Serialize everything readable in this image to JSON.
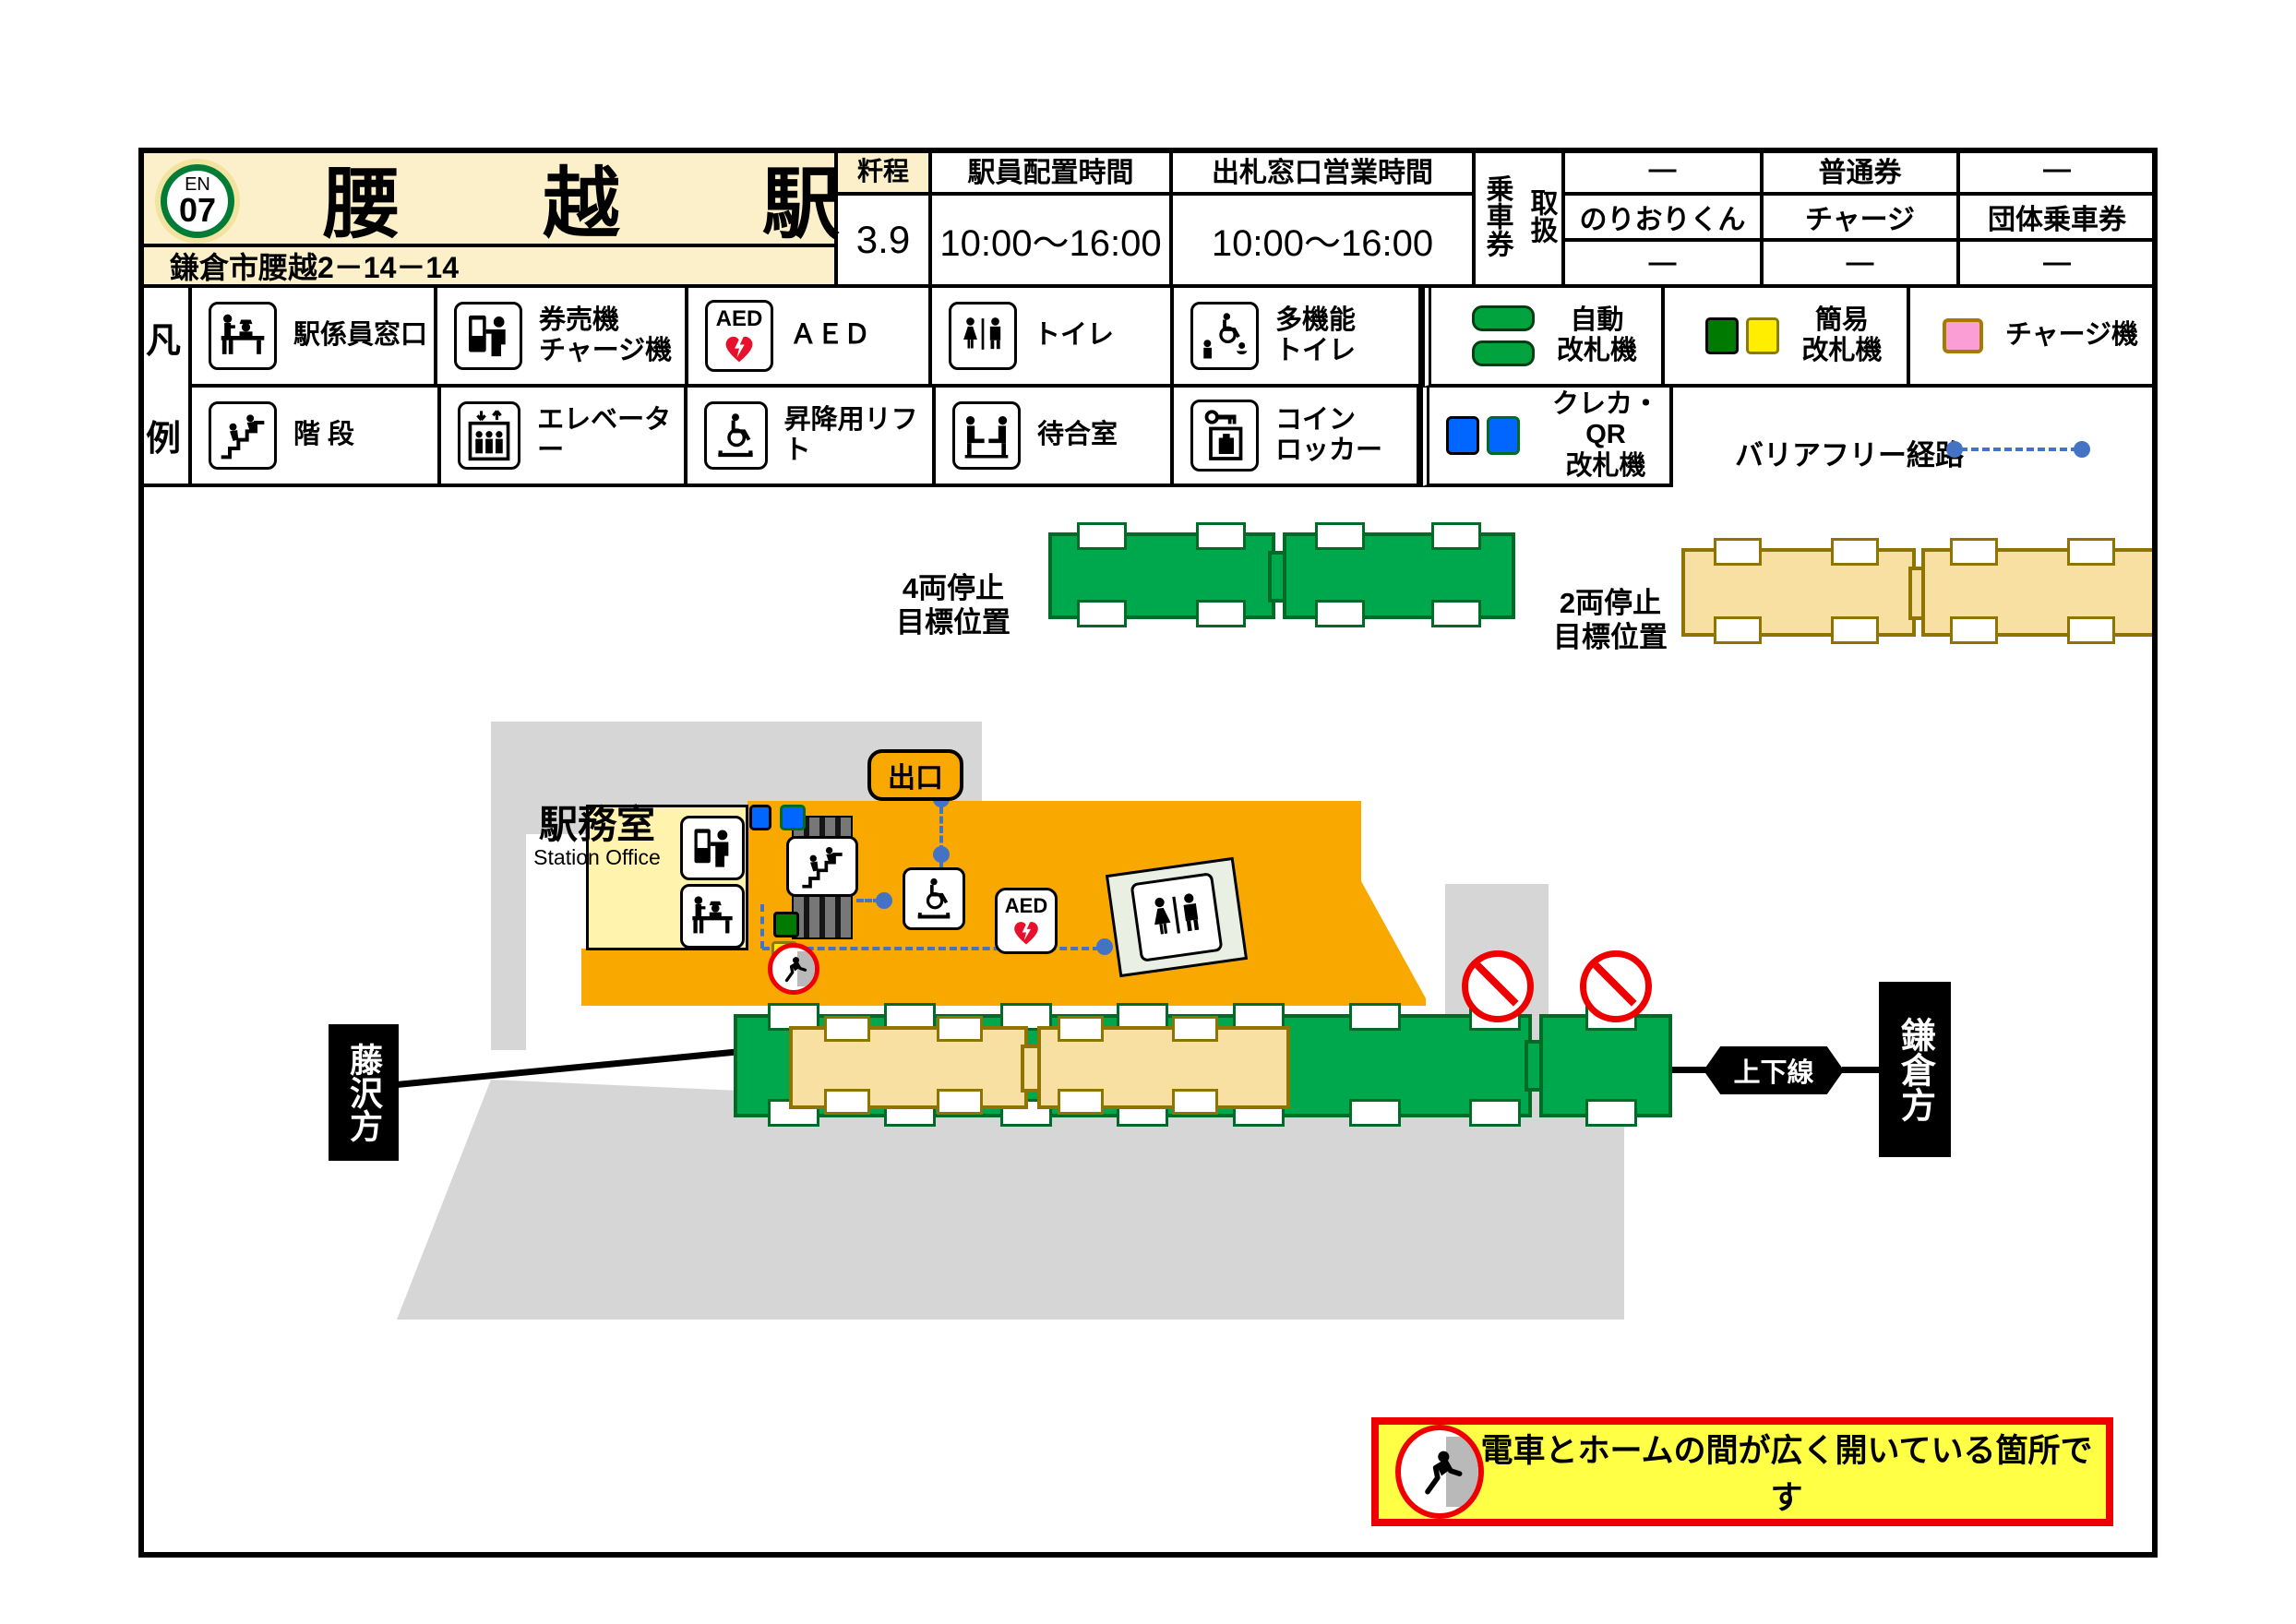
{
  "header": {
    "badge_line": "EN",
    "badge_number": "07",
    "station_name_chars": [
      "腰",
      "越",
      "駅"
    ],
    "address": "鎌倉市腰越2－14－14",
    "mileage_label": "粁程",
    "mileage_value": "3.9",
    "staff_hours_label": "駅員配置時間",
    "staff_hours_value": "10:00〜16:00",
    "ticket_window_label": "出札窓口営業時間",
    "ticket_window_value": "10:00〜16:00",
    "ticket_handling_col_left": "乗車券",
    "ticket_handling_col_right": "取扱",
    "ticket_table": [
      [
        "—",
        "普通券",
        "—"
      ],
      [
        "のりおりくん",
        "チャージ",
        "団体乗車券"
      ],
      [
        "—",
        "—",
        "—"
      ]
    ]
  },
  "legend": {
    "title_chars": [
      "凡",
      "例"
    ],
    "row1_labels": [
      "駅係員窓口",
      "券売機\nチャージ機",
      "ＡＥＤ",
      "トイレ",
      "多機能\nトイレ",
      "自動\n改札機",
      "簡易\n改札機",
      "チャージ機"
    ],
    "row2_labels": [
      "階 段",
      "エレベーター",
      "昇降用リフト",
      "待合室",
      "コイン\nロッカー",
      "クレカ・QR\n改札機"
    ],
    "barrier_free_label": "バリアフリー経路",
    "aed_text": "AED"
  },
  "stop_positions": {
    "four_car_label": "4両停止\n目標位置",
    "two_car_label": "2両停止\n目標位置"
  },
  "map": {
    "office_title": "駅務室",
    "office_subtitle": "Station Office",
    "exit_label": "出口",
    "updown_line_label": "上下線",
    "kamakura_label": "鎌倉方",
    "fujisawa_label": "藤沢方",
    "aed_text": "AED"
  },
  "warning_banner": {
    "text": "電車とホームの間が広く開いている箇所です"
  },
  "colors": {
    "line_green": "#007C36",
    "header_cream": "#FBF0C9",
    "concourse_orange": "#F9A800",
    "office_yellow": "#FFF3AE",
    "train_green": "#00A84D",
    "train_green_border": "#006B27",
    "train_cream": "#F8DFA2",
    "train_cream_border": "#8F7400",
    "path_blue": "#4472C4",
    "gate_blue": "#0066FF",
    "gate_green": "#007A00",
    "gate_yellow": "#FFEE00",
    "charge_pink": "#FB9ED6",
    "warning_red": "#EE0000",
    "warning_yellow": "#FFFF45",
    "footprint_gray": "#D6D6D6"
  }
}
